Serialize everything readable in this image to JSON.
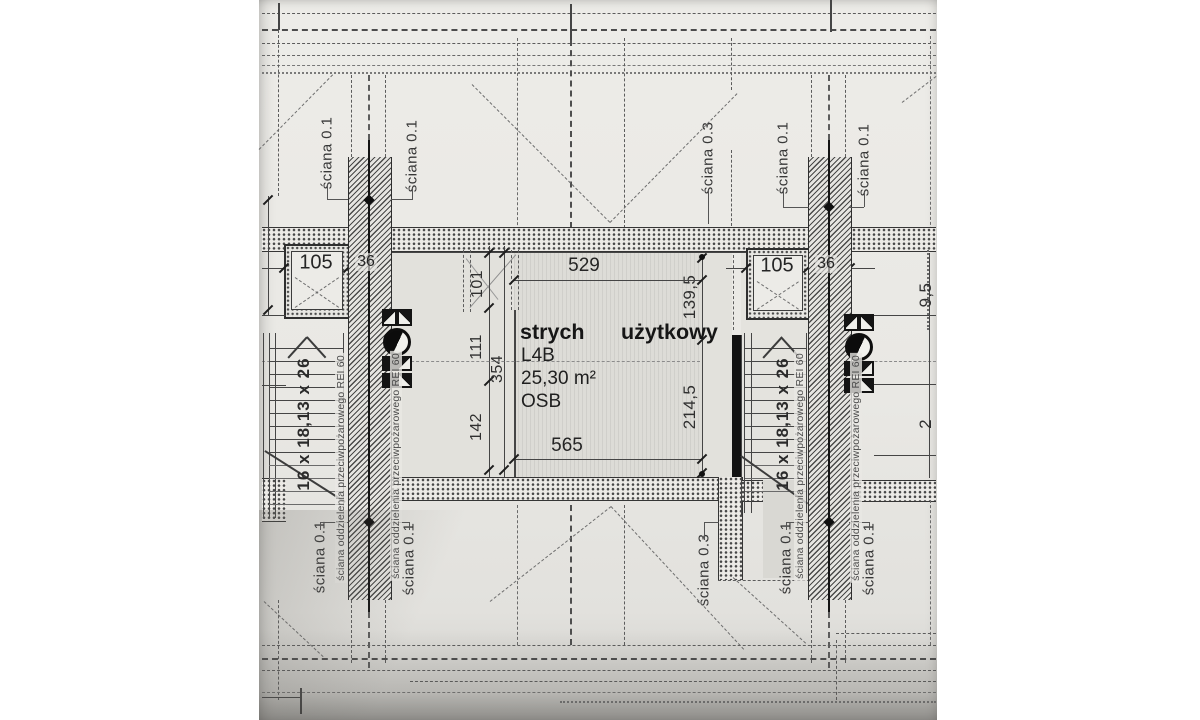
{
  "room": {
    "name_word1": "strych",
    "name_word2": "użytkowy",
    "code": "L4B",
    "area": "25,30 m²",
    "floor_material": "OSB"
  },
  "dims": {
    "top_width": "529",
    "bottom_width": "565",
    "right_upper": "139,5",
    "right_lower": "214,5",
    "left_seg1": "101",
    "left_seg2": "111",
    "left_seg3": "142",
    "left_total": "354",
    "shaft": "105",
    "wall_thickness": "36",
    "edge_upper": "9,5",
    "edge_lower": "2"
  },
  "stairs": {
    "spec": "16 x 18,13 x 26"
  },
  "labels": {
    "wall01": "ściana 0.1",
    "wall03": "ściana 0.3",
    "firewall": "ściana oddzielenia przeciwpożarowego REI 60"
  },
  "colors": {
    "paper": "#e9e8e4",
    "ink": "#3a3a3a",
    "floor": "#dedcd7",
    "wall_black": "#141414"
  }
}
